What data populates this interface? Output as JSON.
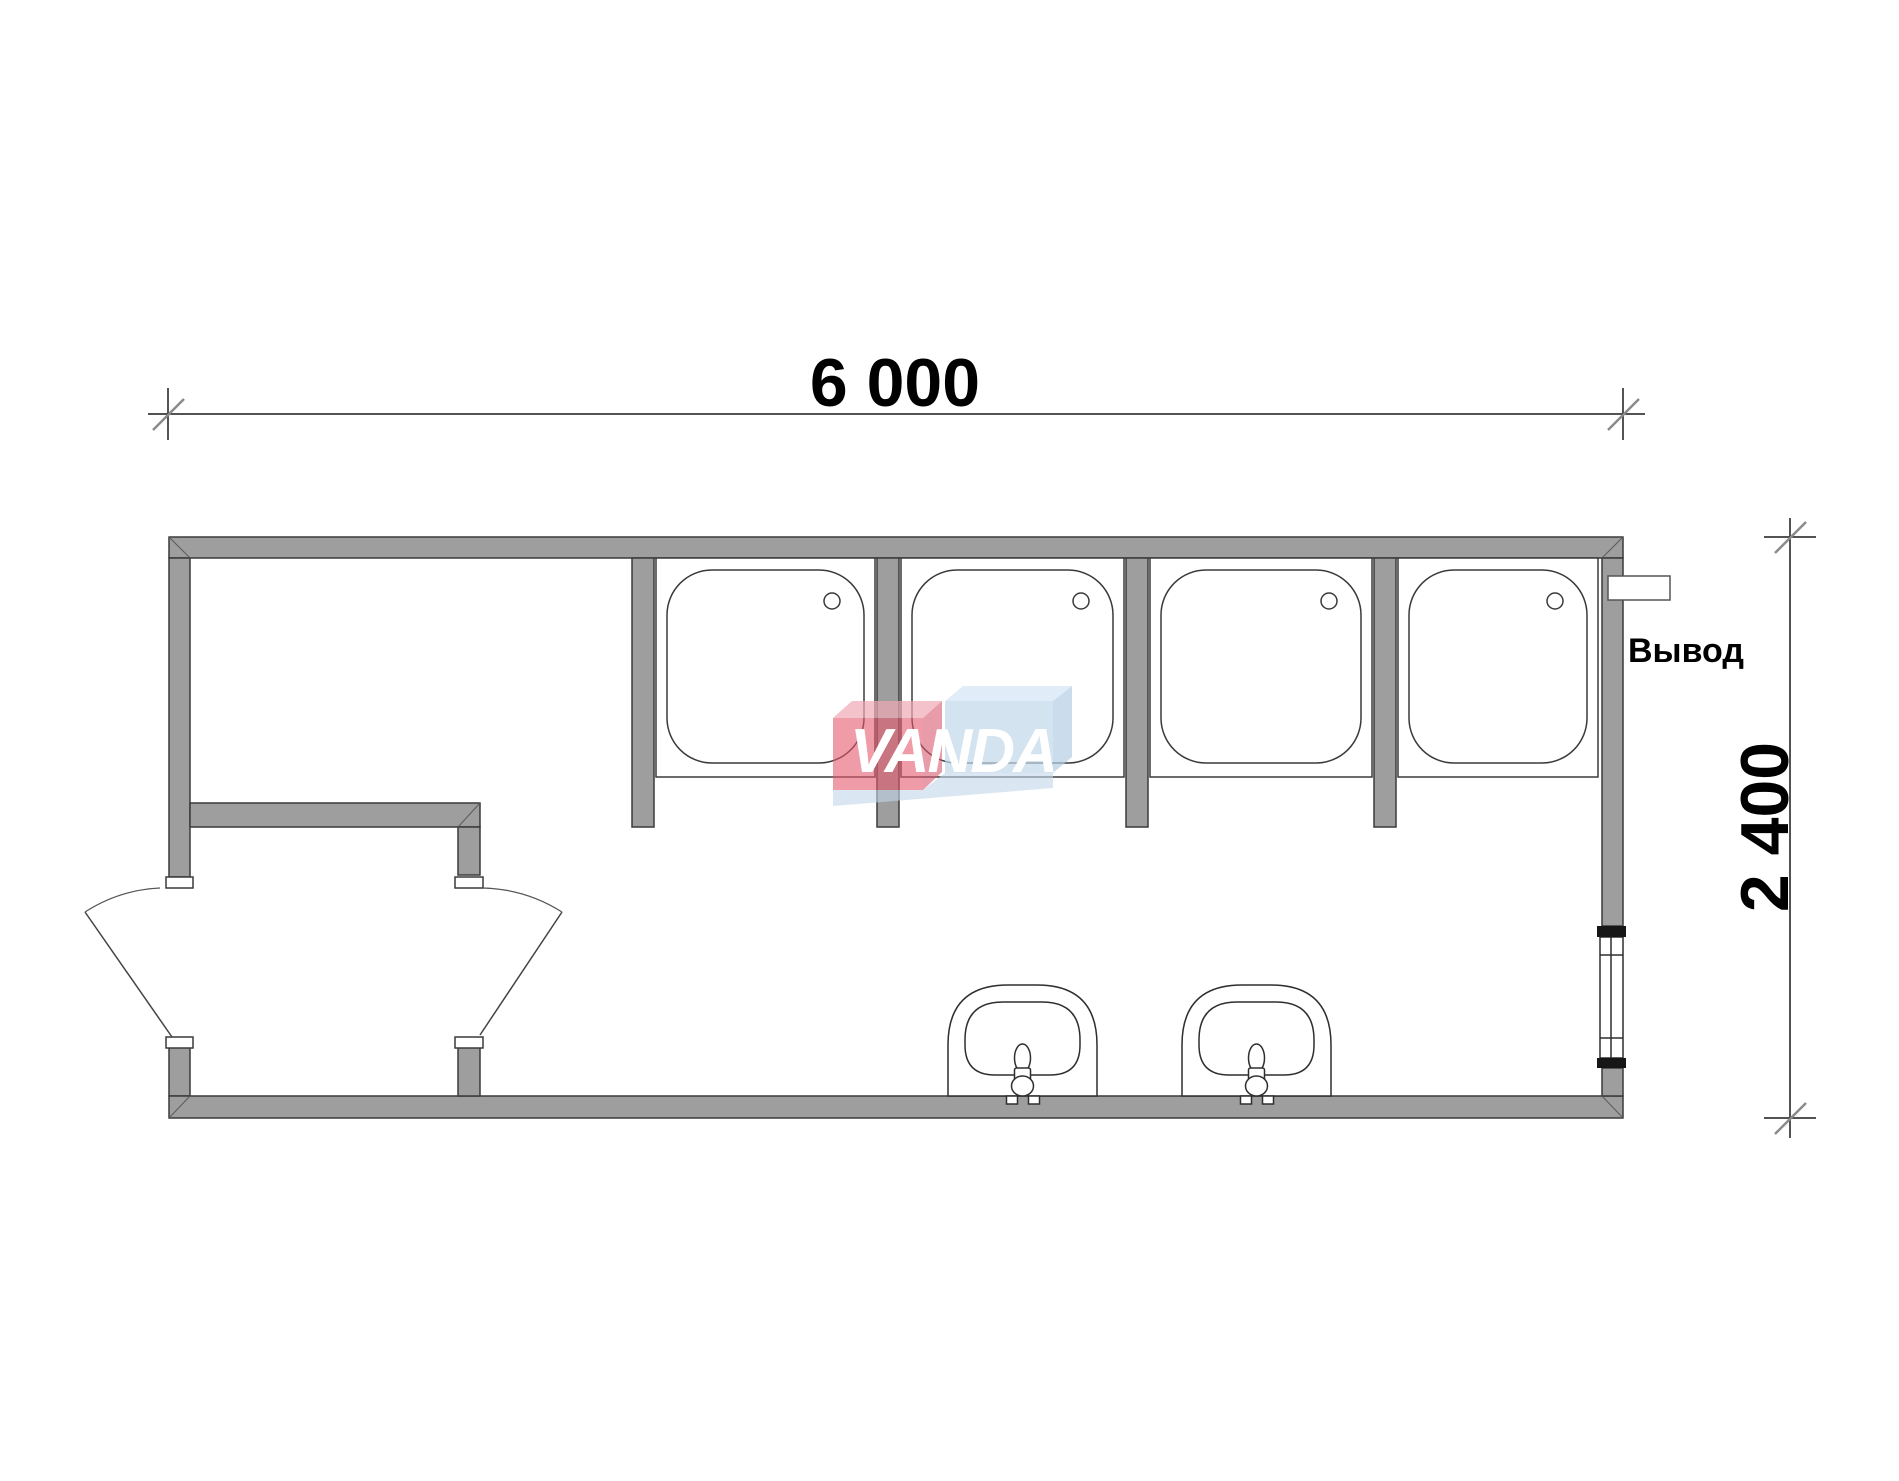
{
  "drawing": {
    "type": "floor-plan",
    "dimensions": {
      "width_label": "6 000",
      "height_label": "2 400"
    },
    "labels": {
      "outlet": "Вывод"
    },
    "watermark": {
      "text": "VANDA",
      "red": "#e55a6e",
      "blue": "#c2d7ea"
    },
    "fixtures": {
      "shower_stalls": 4,
      "washbasins": 2,
      "door_leaves": 2,
      "windows": 1
    },
    "colors": {
      "wall_fill": "#9e9e9e",
      "line": "#3a3a3a",
      "tick": "#8a8a8a",
      "background": "#ffffff"
    }
  }
}
